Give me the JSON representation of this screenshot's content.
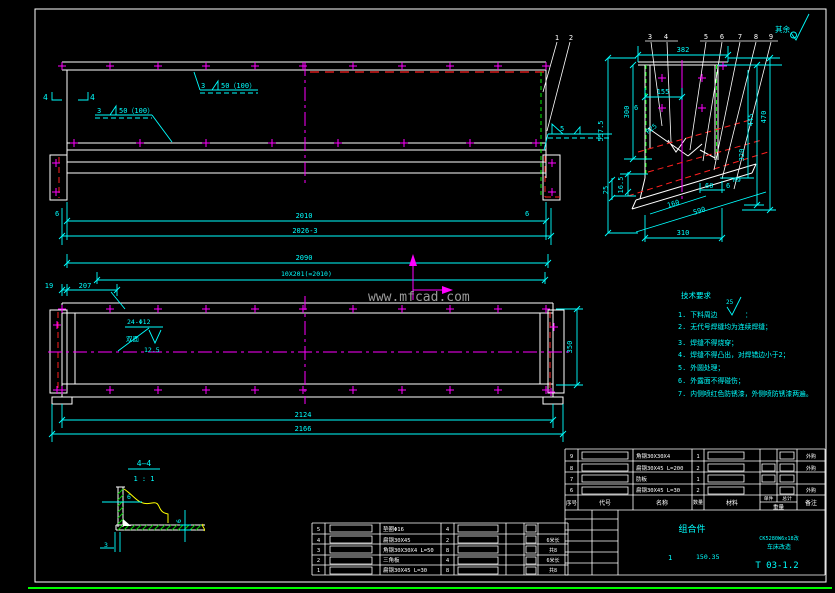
{
  "watermark": "www.mfcad.com",
  "colors": {
    "background": "#000000",
    "line": "#ffffff",
    "dimension": "#00ffff",
    "centerline": "#ff00ff",
    "hidden": "#ff2020",
    "aux_green": "#00ff00",
    "break_yellow": "#ffff00",
    "watermark_gray": "#9b9b9b"
  },
  "top_view": {
    "balloon_1": "1",
    "balloon_2": "2",
    "weld_upper_size": "3",
    "weld_upper_spec": "50（100）",
    "weld_lower_size": "3",
    "weld_lower_spec": "50（100）",
    "section_mark_left": "4",
    "section_mark_right": "4",
    "weld_right_size": "5",
    "weld_leg_left": "6",
    "weld_leg_right": "6",
    "dim_inner_length": "2010",
    "dim_overall_length": "2026-3"
  },
  "detail_view": {
    "surface_note": "其余",
    "balloons": [
      "3",
      "4",
      "5",
      "6",
      "7",
      "8",
      "9"
    ],
    "dims": {
      "width_top": "382",
      "w155": "155",
      "t6": "6",
      "h300": "300",
      "h5575": "557.5",
      "h445": "445",
      "h470": "470",
      "h320": "320",
      "h165": "16.5",
      "h25": "25",
      "l160": "160",
      "l590": "590",
      "w310": "310",
      "w60": "60",
      "t6b": "6",
      "r9": "R9",
      "r25": "R25"
    }
  },
  "plan_view": {
    "dim_2090": "2090",
    "dim_pitch": "10X201(=2010)",
    "dim_19": "19",
    "dim_207": "207",
    "hole_callout": "24-Φ12",
    "hole_callout_sub": "双面",
    "hole_roughness": "12.5",
    "dim_350": "350",
    "dim_2124": "2124",
    "dim_2166": "2166"
  },
  "notes": {
    "title": "技术要求",
    "line1": "1. 下料周边",
    "line1_rough": "25",
    "line1_tail": "：",
    "line2": "2. 无代号焊缝均为连续焊缝；",
    "line3": "3. 焊缝不得烧穿；",
    "line4": "4. 焊缝不得凸出，对焊错边小于2；",
    "line5": "5. 外圆处理；",
    "line6": "6. 外露面不得碰伤；",
    "line7": "7. 内侧喷红色防锈漆，外侧喷防锈漆两遍。"
  },
  "section_view": {
    "label": "4—4",
    "scale": "1 : 1",
    "dim_web": "6",
    "dim_flange": "6",
    "dim_gap": "3"
  },
  "title_block": {
    "headers": {
      "seq": "序号",
      "code": "代号",
      "name": "名称",
      "qty": "数量",
      "material": "材料",
      "unit": "单件",
      "total": "总计",
      "weight": "重量",
      "remark": "备注"
    },
    "rows": [
      {
        "seq": "9",
        "name": "角钢30X30X4",
        "qty": "1",
        "remark": "外购"
      },
      {
        "seq": "8",
        "name": "扁钢30X45 L=200",
        "qty": "2",
        "remark": "外购"
      },
      {
        "seq": "7",
        "name": "肋板",
        "qty": "1",
        "remark": ""
      },
      {
        "seq": "6",
        "name": "扁钢30X45 L=30",
        "qty": "2",
        "remark": "外购"
      }
    ],
    "part_name": "组合件",
    "qty": "1",
    "weight": "150.35",
    "project_line1": "CK5280W6x18改",
    "project_line2": "车床改造",
    "drawing_no": "T 03-1.2"
  },
  "parts_table": {
    "rows": [
      {
        "seq": "5",
        "name": "垫圈Φ16",
        "qty": "4",
        "remark": ""
      },
      {
        "seq": "4",
        "name": "扁钢30X45",
        "qty": "2",
        "remark": "6米长"
      },
      {
        "seq": "3",
        "name": "角钢30X30X4 L=50",
        "qty": "8",
        "remark": "共8"
      },
      {
        "seq": "2",
        "name": "三角板",
        "qty": "4",
        "remark": "6米长"
      },
      {
        "seq": "1",
        "name": "扁钢30X45 L=30",
        "qty": "8",
        "remark": "共8"
      }
    ]
  }
}
